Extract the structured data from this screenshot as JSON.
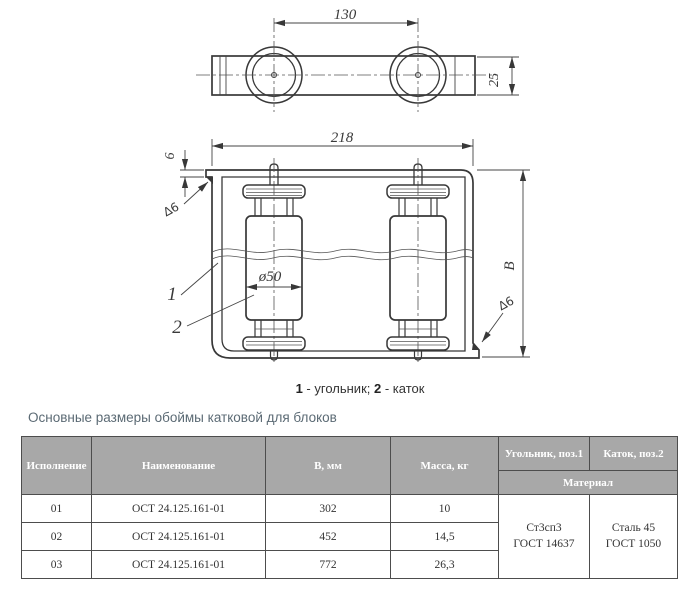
{
  "title": "Основные размеры обоймы катковой для блоков",
  "drawing": {
    "dims": {
      "roller_spacing": "130",
      "bar_height": "25",
      "frame_width": "218",
      "plate_thickness": "6",
      "frame_height": "B",
      "roller_diameter": "ø50"
    },
    "welds": {
      "top_left": "∆6",
      "bottom_right": "∆6"
    },
    "part_labels": {
      "pos1": "1",
      "pos2": "2"
    },
    "caption": {
      "num1": "1",
      "text1": " - угольник; ",
      "num2": "2",
      "text2": " - каток"
    }
  },
  "table": {
    "headers": {
      "version": "Исполнение",
      "name": "Наименование",
      "b_mm": "В, мм",
      "mass_kg": "Масса, кг",
      "angle_pos1": "Угольник, поз.1",
      "roller_pos2": "Каток, поз.2",
      "material": "Материал"
    },
    "rows": [
      {
        "version": "01",
        "name": "ОСТ 24.125.161-01",
        "b": "302",
        "mass": "10"
      },
      {
        "version": "02",
        "name": "ОСТ 24.125.161-01",
        "b": "452",
        "mass": "14,5"
      },
      {
        "version": "03",
        "name": "ОСТ 24.125.161-01",
        "b": "772",
        "mass": "26,3"
      }
    ],
    "materials": {
      "angle_line1": "Ст3сп3",
      "angle_line2": "ГОСТ 14637",
      "roller_line1": "Сталь 45",
      "roller_line2": "ГОСТ 1050"
    }
  },
  "colors": {
    "header_bg": "#a8a8a8",
    "header_text": "#ffffff",
    "table_border": "#4d4d4d",
    "body_text": "#333333",
    "title_text": "#5b6a74",
    "line_color": "#383838"
  }
}
